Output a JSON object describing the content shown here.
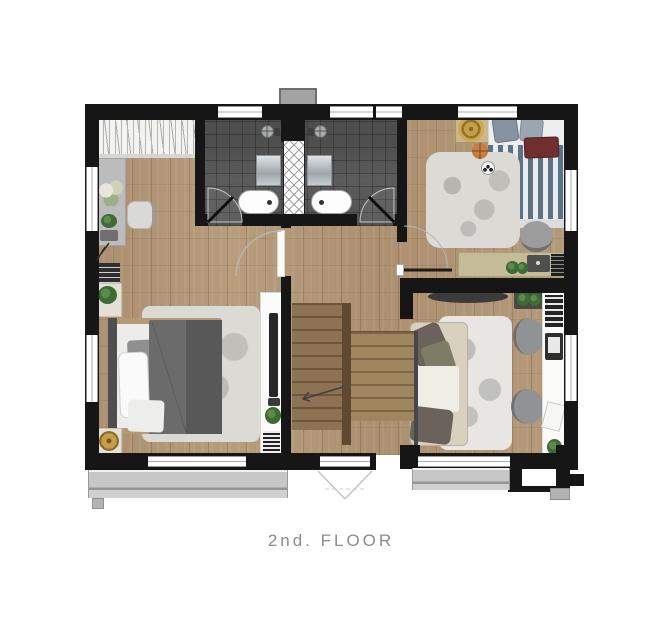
{
  "caption": "2nd. FLOOR",
  "palette": {
    "wall": "#161616",
    "wood": "#b09576",
    "tile": "#565657",
    "rug": "#dbdad5",
    "balcony": "#c7c7c7",
    "stair_dark": "#8d7254",
    "stair_light": "#a0865f",
    "duvet": "#6b6b6b",
    "stripe_blue": "#5d7383",
    "sofa": "#d8d1c0",
    "gold": "#c39f47",
    "tan_wardrobe": "#c9b88e",
    "maroon": "#6f2f2e",
    "basketball": "#c1763c",
    "plant_green": "#3e6b35",
    "caption": "#8c8c8c"
  }
}
